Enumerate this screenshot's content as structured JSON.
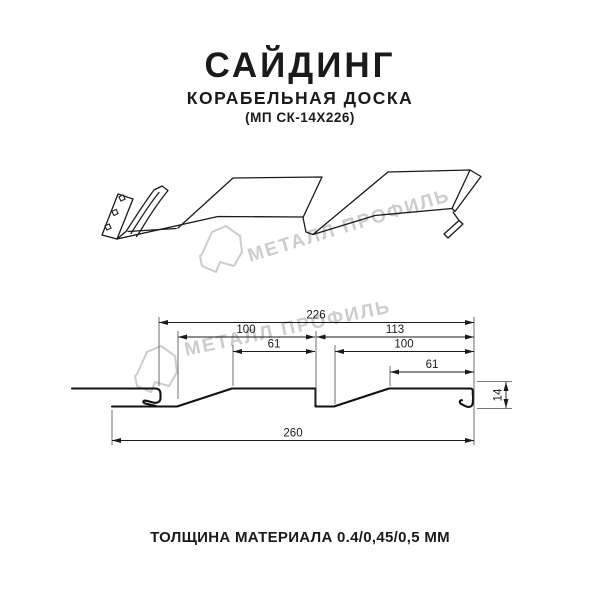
{
  "header": {
    "title": "САЙДИНГ",
    "subtitle": "КОРАБЕЛЬНАЯ ДОСКА",
    "model": "(МП СК-14Х226)"
  },
  "footer": {
    "thickness_label": "ТОЛЩИНА МАТЕРИАЛА 0.4/0,45/0,5 ММ"
  },
  "watermark": {
    "text": "МЕТАЛЛ ПРОФИЛЬ",
    "color": "#cccccc"
  },
  "colors": {
    "line": "#1a1a1a",
    "background": "#ffffff",
    "watermark": "#cccccc"
  },
  "dims": {
    "overall_top": "226",
    "left_upper": "100",
    "right_upper": "113",
    "left_inner": "61",
    "right_inner": "100",
    "right_lower": "61",
    "overall_bottom": "260",
    "height": "14"
  }
}
